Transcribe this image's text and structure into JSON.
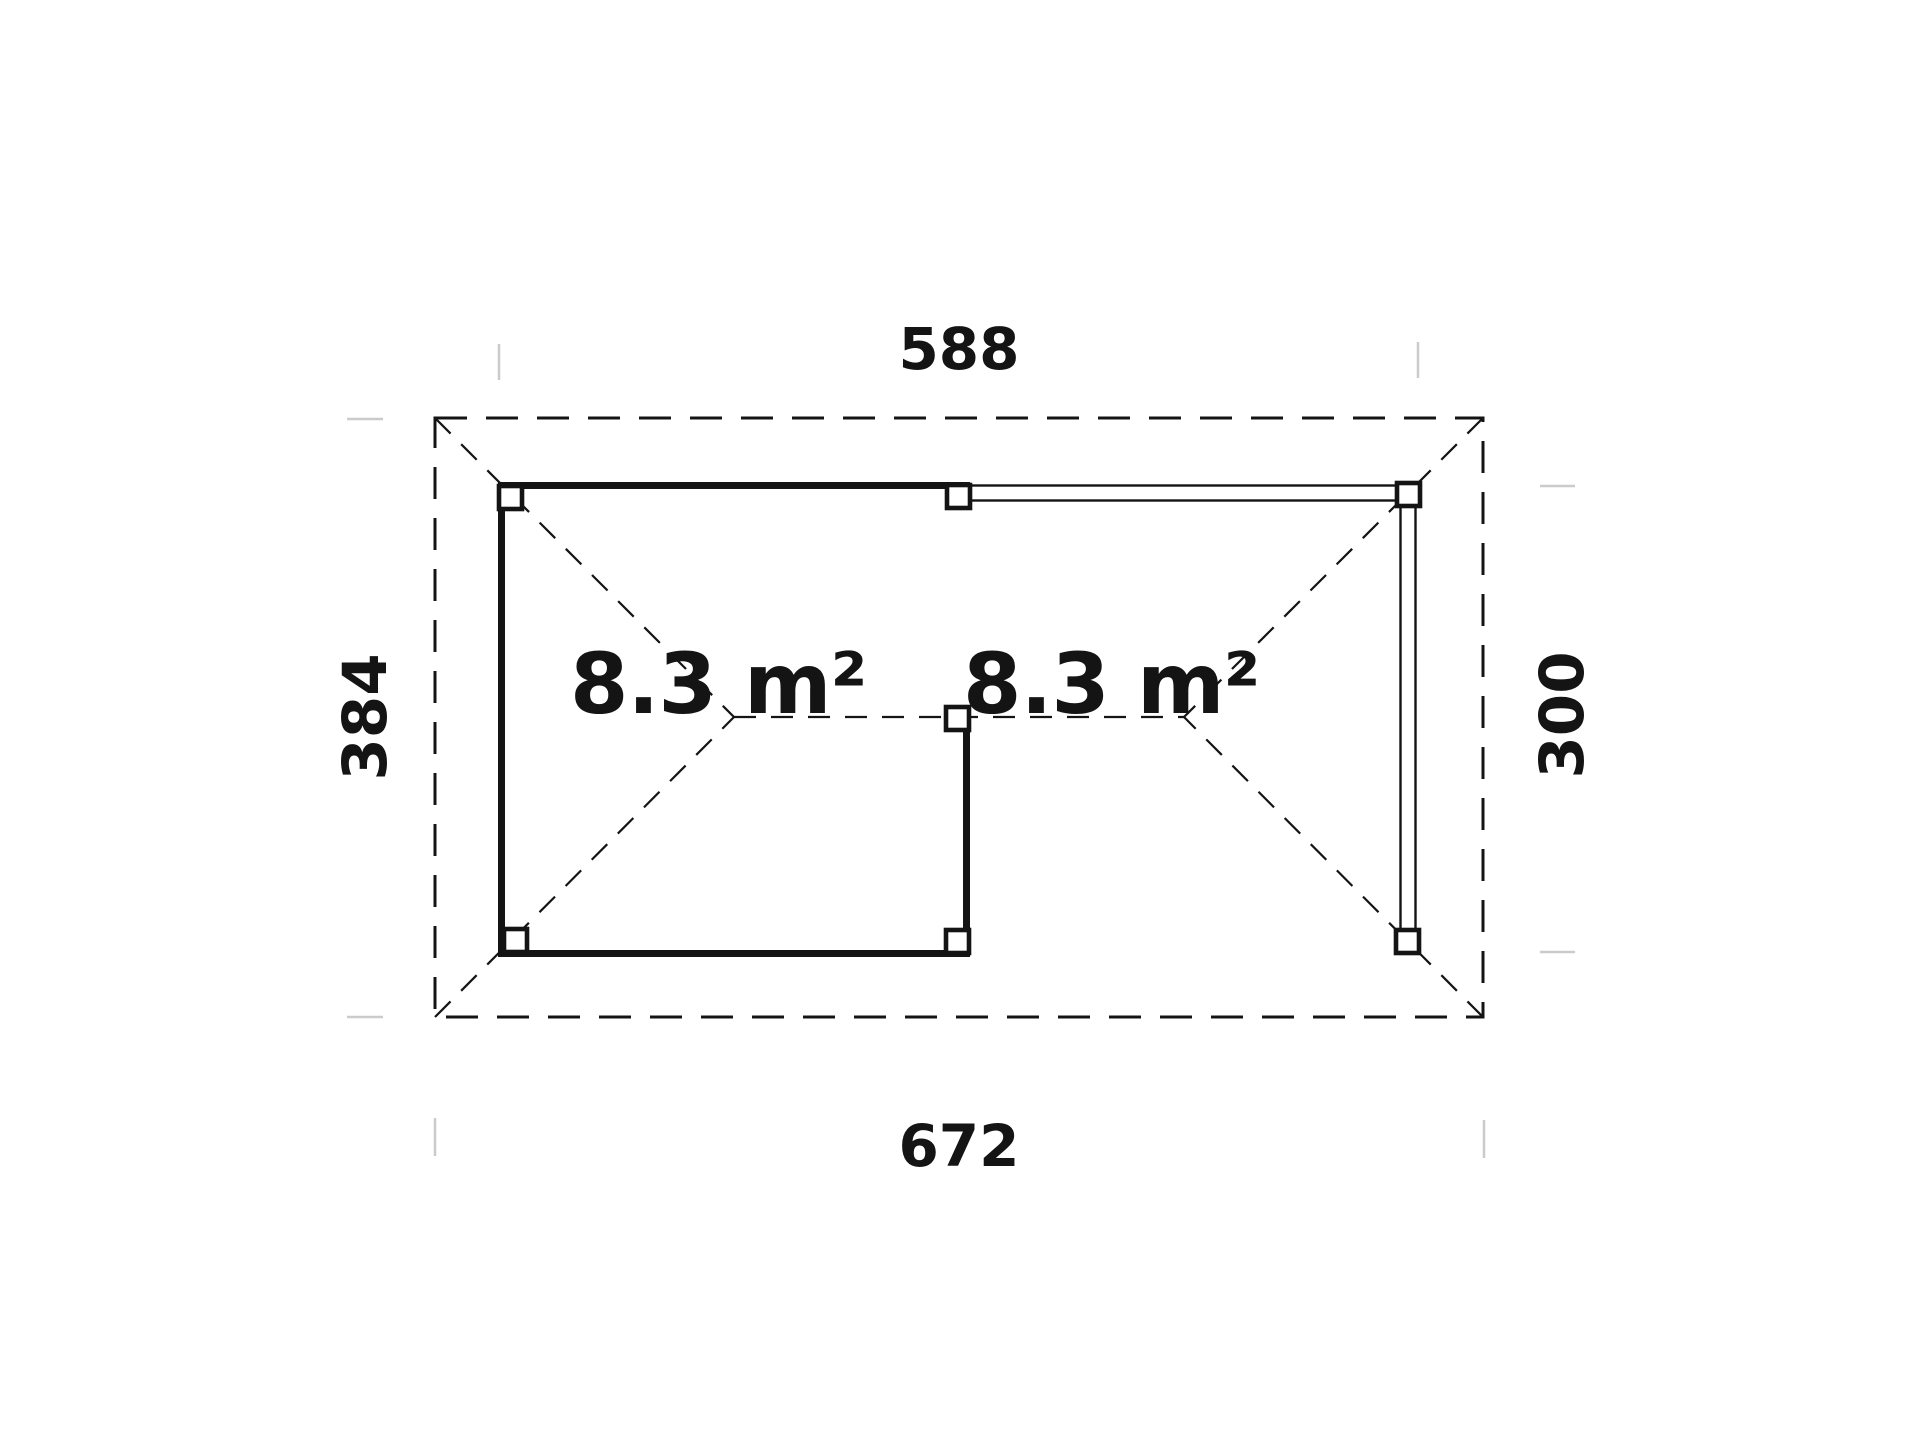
{
  "canvas": {
    "width": 1920,
    "height": 1439,
    "background": "#ffffff"
  },
  "floor_plan": {
    "type": "garden-house-roof-plan",
    "dimension_labels": {
      "top": "588",
      "bottom": "672",
      "left": "384",
      "right": "300"
    },
    "area_labels": {
      "room": "8.3 m²",
      "canopy": "8.3 m²"
    },
    "colors": {
      "line": "#141414",
      "extension_tick": "#cbcbcb",
      "background": "#ffffff"
    }
  }
}
